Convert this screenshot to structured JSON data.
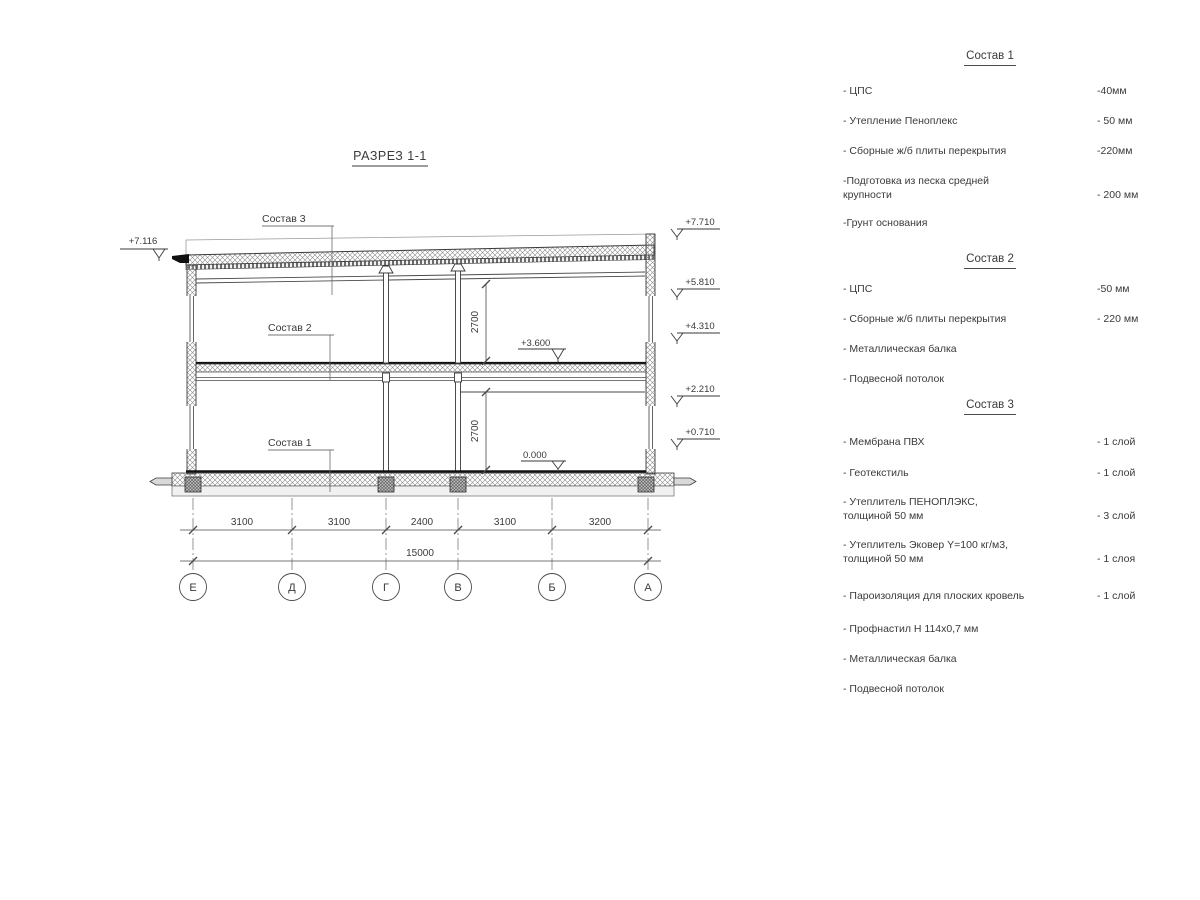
{
  "drawing": {
    "title": "РАЗРЕЗ 1-1",
    "callouts": {
      "roof": "Состав 3",
      "mid": "Состав 2",
      "ground": "Состав 1"
    },
    "levels": {
      "left_top": "+7.116",
      "right": [
        "+7.710",
        "+5.810",
        "+4.310",
        "+2.210",
        "+0.710"
      ],
      "floor2": "+3.600",
      "floor1": "0.000"
    },
    "heights": [
      "2700",
      "2700"
    ],
    "dims": [
      "3100",
      "3100",
      "2400",
      "3100",
      "3200"
    ],
    "total": "15000",
    "axes": [
      "Е",
      "Д",
      "Г",
      "В",
      "Б",
      "А"
    ]
  },
  "panel": {
    "sections": [
      {
        "header": "Состав 1",
        "items": [
          {
            "n": "- ЦПС",
            "v": "-40мм"
          },
          {
            "n": "- Утепление Пеноплекс",
            "v": "- 50 мм"
          },
          {
            "n": "- Сборные ж/б плиты перекрытия",
            "v": "-220мм"
          },
          {
            "n": "-Подготовка из песка средней",
            "n2": "крупности",
            "v": "- 200 мм"
          },
          {
            "n": "-Грунт основания"
          }
        ]
      },
      {
        "header": "Состав 2",
        "items": [
          {
            "n": "- ЦПС",
            "v": "-50 мм"
          },
          {
            "n": "- Сборные ж/б плиты перекрытия",
            "v": "- 220 мм"
          },
          {
            "n": "- Металлическая балка"
          },
          {
            "n": "- Подвесной потолок"
          }
        ]
      },
      {
        "header": "Состав 3",
        "items": [
          {
            "n": "- Мембрана ПВХ",
            "v": "- 1 слой"
          },
          {
            "n": "- Геотекстиль",
            "v": "- 1 слой"
          },
          {
            "n": "- Утеплитель ПЕНОПЛЭКС,",
            "n2": "толщиной 50 мм",
            "v": "- 3 слой"
          },
          {
            "n": "- Утеплитель Эковер Y=100 кг/м3,",
            "n2": "толщиной 50 мм",
            "v": "- 1 слоя"
          },
          {
            "n": "- Пароизоляция для плоских кровель",
            "v": "- 1 слой"
          },
          {
            "n": "- Профнастил Н 114х0,7 мм"
          },
          {
            "n": "- Металлическая балка"
          },
          {
            "n": "- Подвесной потолок"
          }
        ]
      }
    ]
  }
}
